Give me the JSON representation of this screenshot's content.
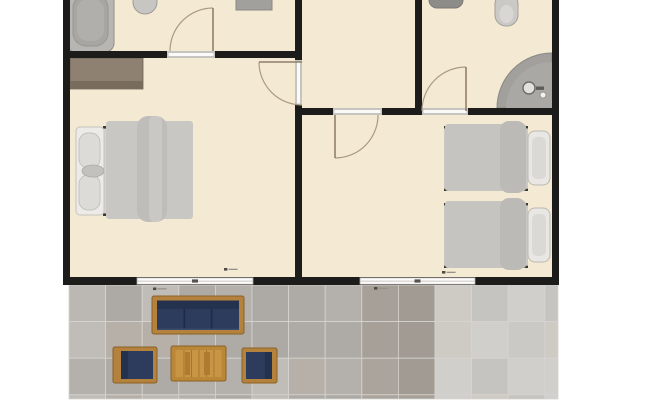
{
  "title": "apartment-floor-plan",
  "colors": {
    "background": "#ffffff",
    "floor": "#f4e9d3",
    "wall": "#1c1c1a",
    "threshold": "#c6c4c0",
    "threshold_inner": "#fbfaf8",
    "window_fill": "#fcfbf9",
    "window_edge": "#a8a6a2",
    "window_mid": "#c6c4c0",
    "window_tick": "#54524e",
    "door_leaf": "#8f7f6b",
    "door_arc": "#a89a88",
    "grout": "#d6d4d0",
    "wood": "#b5823e",
    "wood_edge": "#8a6126",
    "navy_cushion": "#2d3b5d",
    "navy_dark": "#24324e"
  },
  "plan": {
    "floor": {
      "k": "rect",
      "n": "interior-floor",
      "x": 63,
      "y": 0,
      "w": 496,
      "h": 285,
      "f": "#f4e9d3"
    },
    "fixtures": [
      {
        "k": "rect",
        "n": "bathtub-outer",
        "x": 67,
        "y": -10,
        "w": 47,
        "h": 62,
        "rx": 9,
        "f": "#b8b6b2",
        "s": "#8f8d89",
        "sw": 1
      },
      {
        "k": "rect",
        "n": "bathtub-inner",
        "x": 73,
        "y": -5,
        "w": 35,
        "h": 51,
        "rx": 13,
        "f": "#a8a6a2",
        "s": "#98968f",
        "sw": 1
      },
      {
        "k": "rect",
        "n": "bathtub-floor",
        "x": 77,
        "y": -1,
        "w": 27,
        "h": 42,
        "rx": 11,
        "f": "#b1afab"
      },
      {
        "k": "ellipse",
        "n": "toilet-topleft",
        "cx": 145,
        "cy": 2,
        "rx": 12,
        "ry": 12,
        "f": "#c8c6c2",
        "s": "#9d9b97",
        "sw": 1
      },
      {
        "k": "rect",
        "n": "bathroom-shelf",
        "x": 236,
        "y": -8,
        "w": 36,
        "h": 18,
        "f": "#a2a09c",
        "s": "#8b8985",
        "sw": 1
      },
      {
        "k": "rect",
        "n": "sink-topright",
        "x": 429,
        "y": -9,
        "w": 34,
        "h": 17,
        "rx": 8,
        "f": "#8e8c88",
        "s": "#7b7975",
        "sw": 1
      },
      {
        "k": "rect",
        "n": "toilet-topright",
        "x": 495,
        "y": -7,
        "w": 23,
        "h": 33,
        "rx": 11,
        "f": "#cbc9c5",
        "s": "#a3a19d",
        "sw": 1
      },
      {
        "k": "ellipse",
        "n": "toilet-topright-bowl",
        "cx": 506.5,
        "cy": 14,
        "rx": 7,
        "ry": 9,
        "f": "#d9d7d3"
      },
      {
        "k": "path",
        "n": "corner-shower",
        "d": "M552,53 A55,55 0 0 0 497,108 L552,108 Z",
        "f": "#a2a09c",
        "s": "#8a8884",
        "sw": 1
      },
      {
        "k": "path",
        "n": "corner-shower-inner",
        "d": "M552,62 A46,46 0 0 0 506,108 L552,108 Z",
        "f": "#aaa8a4"
      },
      {
        "k": "ellipse",
        "n": "shower-drain",
        "cx": 529,
        "cy": 88,
        "rx": 6,
        "ry": 6,
        "f": "#e3e1dd",
        "s": "#6e6c68",
        "sw": 1.4
      },
      {
        "k": "rect",
        "n": "shower-faucet",
        "x": 536,
        "y": 86.5,
        "w": 8,
        "h": 3.4,
        "f": "#5f5d59"
      },
      {
        "k": "ellipse",
        "n": "shower-knob",
        "cx": 543,
        "cy": 95,
        "rx": 3,
        "ry": 3,
        "f": "#f3f1ed",
        "s": "#8a8884",
        "sw": 0.8
      },
      {
        "k": "rect",
        "n": "wardrobe",
        "x": 70,
        "y": 58,
        "w": 73,
        "h": 31,
        "f": "#8e8172",
        "s": "#6c6253",
        "sw": 0.8
      },
      {
        "k": "rect",
        "n": "wardrobe-shadow",
        "x": 70,
        "y": 81,
        "w": 73,
        "h": 8,
        "f": "#786c5c"
      },
      {
        "k": "rect",
        "n": "double-bed-base",
        "x": 103,
        "y": 126,
        "w": 90,
        "h": 90,
        "f": "#d4d2ce"
      },
      {
        "k": "rect",
        "n": "double-bed-frame-top",
        "x": 103,
        "y": 126,
        "w": 90,
        "h": 2.6,
        "f": "#3a3936"
      },
      {
        "k": "rect",
        "n": "double-bed-frame-bottom",
        "x": 103,
        "y": 213.4,
        "w": 90,
        "h": 2.6,
        "f": "#3a3936"
      },
      {
        "k": "rect",
        "n": "double-bed-headboard",
        "x": 76,
        "y": 127,
        "w": 28,
        "h": 88,
        "rx": 4,
        "f": "#edebe7",
        "s": "#c5c3bf",
        "sw": 1
      },
      {
        "k": "rect",
        "n": "pillow",
        "x": 79,
        "y": 133,
        "w": 21,
        "h": 35,
        "rx": 9,
        "f": "#dddbd7",
        "s": "#c2c0bc",
        "sw": 0.9
      },
      {
        "k": "rect",
        "n": "pillow",
        "x": 79,
        "y": 175,
        "w": 21,
        "h": 35,
        "rx": 9,
        "f": "#dddbd7",
        "s": "#c2c0bc",
        "sw": 0.9
      },
      {
        "k": "ellipse",
        "n": "headboard-cushion",
        "cx": 93,
        "cy": 171,
        "rx": 11,
        "ry": 6,
        "f": "#c3c1bd",
        "s": "#adaba7",
        "sw": 0.8
      },
      {
        "k": "rect",
        "n": "double-bed-blanket",
        "x": 106,
        "y": 121,
        "w": 87,
        "h": 98,
        "rx": 3,
        "f": "#c9c7c3"
      },
      {
        "k": "rect",
        "n": "blanket-fold",
        "x": 137,
        "y": 116,
        "w": 30,
        "h": 106,
        "rx": 11,
        "f": "#bfbdb9"
      },
      {
        "k": "rect",
        "n": "blanket-fold-inner",
        "x": 149,
        "y": 116,
        "w": 13,
        "h": 106,
        "rx": 6,
        "f": "#cac8c4"
      },
      {
        "k": "rect",
        "n": "twin-bed-base",
        "x": 444,
        "y": 128,
        "w": 84,
        "h": 60,
        "f": "#cac8c4"
      },
      {
        "k": "rect",
        "n": "twin-bed-frame-top",
        "x": 444,
        "y": 126,
        "w": 84,
        "h": 2.4,
        "f": "#3a3936"
      },
      {
        "k": "rect",
        "n": "twin-bed-frame-bottom",
        "x": 444,
        "y": 188.6,
        "w": 84,
        "h": 2.4,
        "f": "#3a3936"
      },
      {
        "k": "rect",
        "n": "twin-bed-blanket",
        "x": 445,
        "y": 124,
        "w": 81,
        "h": 67,
        "rx": 3,
        "f": "#c6c4c0"
      },
      {
        "k": "rect",
        "n": "twin-blanket-fold",
        "x": 500,
        "y": 121,
        "w": 26,
        "h": 72,
        "rx": 9,
        "f": "#bcbab6"
      },
      {
        "k": "rect",
        "n": "twin-pillow",
        "x": 528,
        "y": 131,
        "w": 22,
        "h": 54,
        "rx": 7,
        "f": "#e9e7e3",
        "s": "#bab8b4",
        "sw": 1
      },
      {
        "k": "rect",
        "n": "twin-pillow-inner",
        "x": 532,
        "y": 137,
        "w": 14,
        "h": 42,
        "rx": 5,
        "f": "#dbd9d5"
      },
      {
        "k": "rect",
        "n": "twin-bed-base",
        "x": 444,
        "y": 205,
        "w": 84,
        "h": 60,
        "f": "#cac8c4"
      },
      {
        "k": "rect",
        "n": "twin-bed-frame-top",
        "x": 444,
        "y": 203,
        "w": 84,
        "h": 2.4,
        "f": "#3a3936"
      },
      {
        "k": "rect",
        "n": "twin-bed-frame-bottom",
        "x": 444,
        "y": 265.6,
        "w": 84,
        "h": 2.4,
        "f": "#3a3936"
      },
      {
        "k": "rect",
        "n": "twin-bed-blanket",
        "x": 445,
        "y": 201,
        "w": 81,
        "h": 67,
        "rx": 3,
        "f": "#c6c4c0"
      },
      {
        "k": "rect",
        "n": "twin-blanket-fold",
        "x": 500,
        "y": 198,
        "w": 26,
        "h": 72,
        "rx": 9,
        "f": "#bcbab6"
      },
      {
        "k": "rect",
        "n": "twin-pillow",
        "x": 528,
        "y": 208,
        "w": 22,
        "h": 54,
        "rx": 7,
        "f": "#e9e7e3",
        "s": "#bab8b4",
        "sw": 1
      },
      {
        "k": "rect",
        "n": "twin-pillow-inner",
        "x": 532,
        "y": 214,
        "w": 14,
        "h": 42,
        "rx": 5,
        "f": "#dbd9d5"
      }
    ],
    "walls": [
      {
        "n": "wall-outer-left",
        "x": 63,
        "y": 0,
        "w": 7,
        "h": 285
      },
      {
        "n": "wall-outer-right",
        "x": 552,
        "y": 0,
        "w": 7,
        "h": 285
      },
      {
        "n": "wall-outer-bottom",
        "x": 63,
        "y": 277,
        "w": 496,
        "h": 8
      },
      {
        "n": "wall-bath1-south",
        "x": 63,
        "y": 51,
        "w": 239,
        "h": 7
      },
      {
        "n": "wall-center-vertical",
        "x": 295,
        "y": 0,
        "w": 7,
        "h": 285
      },
      {
        "n": "wall-hall-east",
        "x": 415,
        "y": 0,
        "w": 7,
        "h": 115
      },
      {
        "n": "wall-mid-horizontal",
        "x": 295,
        "y": 108,
        "w": 264,
        "h": 7
      }
    ],
    "thresholds": [
      {
        "n": "door-opening-bath1",
        "x": 167,
        "y": 51,
        "w": 48,
        "h": 7,
        "horiz": true
      },
      {
        "n": "door-opening-bedroom1",
        "x": 295,
        "y": 60,
        "w": 7,
        "h": 45,
        "horiz": false
      },
      {
        "n": "door-opening-bedroom2",
        "x": 333,
        "y": 108,
        "w": 49,
        "h": 7,
        "horiz": true
      },
      {
        "n": "door-opening-bath2",
        "x": 422,
        "y": 108,
        "w": 46,
        "h": 7,
        "horiz": true
      }
    ],
    "windows": [
      {
        "n": "window-left",
        "x": 137,
        "y": 277.8,
        "w": 116,
        "h": 6.5
      },
      {
        "n": "window-right",
        "x": 360,
        "y": 277.8,
        "w": 115,
        "h": 6.5
      }
    ],
    "doors": [
      {
        "n": "door-bath1",
        "leaf": [
          213,
          8,
          213,
          51
        ],
        "arc": "M170,51 A43,43 0 0 1 213,8"
      },
      {
        "n": "door-bedroom1",
        "leaf": [
          302,
          62,
          259,
          62
        ],
        "arc": "M259,62 A43,43 0 0 0 302,105"
      },
      {
        "n": "door-bedroom2",
        "leaf": [
          335,
          115,
          335,
          158
        ],
        "arc": "M335,158 A43,43 0 0 0 378,115"
      },
      {
        "n": "door-bath2",
        "leaf": [
          466,
          111,
          466,
          67
        ],
        "arc": "M466,67 A44,44 0 0 0 422,111"
      }
    ],
    "markers": [
      {
        "n": "dimension-marker",
        "x": 224,
        "y": 268
      },
      {
        "n": "dimension-marker",
        "x": 442,
        "y": 271
      },
      {
        "n": "dimension-marker",
        "x": 153,
        "y": 287.5
      },
      {
        "n": "dimension-marker",
        "x": 374,
        "y": 287
      }
    ]
  },
  "patio": {
    "tiles": {
      "x": 69,
      "y": 285,
      "x2": 558,
      "y2": 399,
      "size": 36.6,
      "seed": 7,
      "zones": [
        {
          "maxX": 363,
          "palette": [
            "#b4b1ac",
            "#bbb8b3",
            "#aeaba6",
            "#c0bdb8",
            "#b6b0a8",
            "#adaaa5"
          ]
        },
        {
          "maxX": 430,
          "palette": [
            "#a6a098",
            "#aba49c",
            "#a19b93"
          ]
        },
        {
          "maxX": 999,
          "palette": [
            "#cbc9c5",
            "#d1cfcb",
            "#c6c4c0",
            "#cecac4"
          ]
        }
      ]
    },
    "furniture": [
      {
        "k": "rect",
        "n": "patio-sofa-frame",
        "x": 152,
        "y": 296,
        "w": 92,
        "h": 38,
        "rx": 2,
        "f": "#b5823e",
        "s": "#8a6126",
        "sw": 1
      },
      {
        "k": "rect",
        "n": "patio-sofa-cushions",
        "x": 157,
        "y": 300.5,
        "w": 82,
        "h": 29.5,
        "f": "#2d3b5d"
      },
      {
        "k": "rect",
        "n": "patio-sofa-backrest",
        "x": 157,
        "y": 300.5,
        "w": 82,
        "h": 8.5,
        "f": "#24324e"
      },
      {
        "k": "rect",
        "n": "sofa-divider",
        "x": 183.6,
        "y": 309,
        "w": 1.6,
        "h": 21,
        "f": "#1e2b46"
      },
      {
        "k": "rect",
        "n": "sofa-divider",
        "x": 210.8,
        "y": 309,
        "w": 1.6,
        "h": 21,
        "f": "#1e2b46"
      },
      {
        "k": "rect",
        "n": "sofa-seat-edge",
        "x": 157,
        "y": 328.5,
        "w": 82,
        "h": 1.5,
        "f": "#3a4a6c"
      },
      {
        "k": "rect",
        "n": "patio-table",
        "x": 171,
        "y": 346,
        "w": 55,
        "h": 35,
        "rx": 2,
        "f": "#ba8637",
        "s": "#8a6126",
        "sw": 1
      },
      {
        "k": "rect",
        "n": "patio-table-top",
        "x": 175.5,
        "y": 350,
        "w": 46,
        "h": 27,
        "f": "#c79544"
      },
      {
        "k": "rect",
        "n": "table-plank-line",
        "x": 183.5,
        "y": 350,
        "w": 0.9,
        "h": 27,
        "f": "#9f762e"
      },
      {
        "k": "rect",
        "n": "table-plank-line",
        "x": 191,
        "y": 350,
        "w": 0.9,
        "h": 27,
        "f": "#9f762e"
      },
      {
        "k": "rect",
        "n": "table-plank-line",
        "x": 198.5,
        "y": 350,
        "w": 0.9,
        "h": 27,
        "f": "#9f762e"
      },
      {
        "k": "rect",
        "n": "table-plank-line",
        "x": 206,
        "y": 350,
        "w": 0.9,
        "h": 27,
        "f": "#9f762e"
      },
      {
        "k": "rect",
        "n": "table-plank-line",
        "x": 213.5,
        "y": 350,
        "w": 0.9,
        "h": 27,
        "f": "#9f762e"
      },
      {
        "k": "rect",
        "n": "table-plank-shade",
        "x": 185,
        "y": 352,
        "w": 5,
        "h": 23,
        "f": "#ae7c31"
      },
      {
        "k": "rect",
        "n": "table-plank-shade",
        "x": 204,
        "y": 352,
        "w": 6,
        "h": 23,
        "f": "#ae7c31"
      },
      {
        "k": "rect",
        "n": "patio-chair-frame",
        "x": 113,
        "y": 347,
        "w": 44,
        "h": 36,
        "rx": 2,
        "f": "#b5823e",
        "s": "#8a6126",
        "sw": 1
      },
      {
        "k": "rect",
        "n": "patio-chair-cushion",
        "x": 121,
        "y": 351,
        "w": 32,
        "h": 28,
        "f": "#2d3b5d"
      },
      {
        "k": "rect",
        "n": "patio-chair-backrest",
        "x": 121,
        "y": 351,
        "w": 7,
        "h": 28,
        "f": "#24324e"
      },
      {
        "k": "rect",
        "n": "patio-chair-frame",
        "x": 242,
        "y": 348,
        "w": 35,
        "h": 35,
        "rx": 2,
        "f": "#b5823e",
        "s": "#8a6126",
        "sw": 1
      },
      {
        "k": "rect",
        "n": "patio-chair-cushion",
        "x": 246,
        "y": 352,
        "w": 26,
        "h": 27,
        "f": "#2d3b5d"
      },
      {
        "k": "rect",
        "n": "patio-chair-backrest",
        "x": 265,
        "y": 352,
        "w": 7,
        "h": 27,
        "f": "#24324e"
      }
    ]
  }
}
